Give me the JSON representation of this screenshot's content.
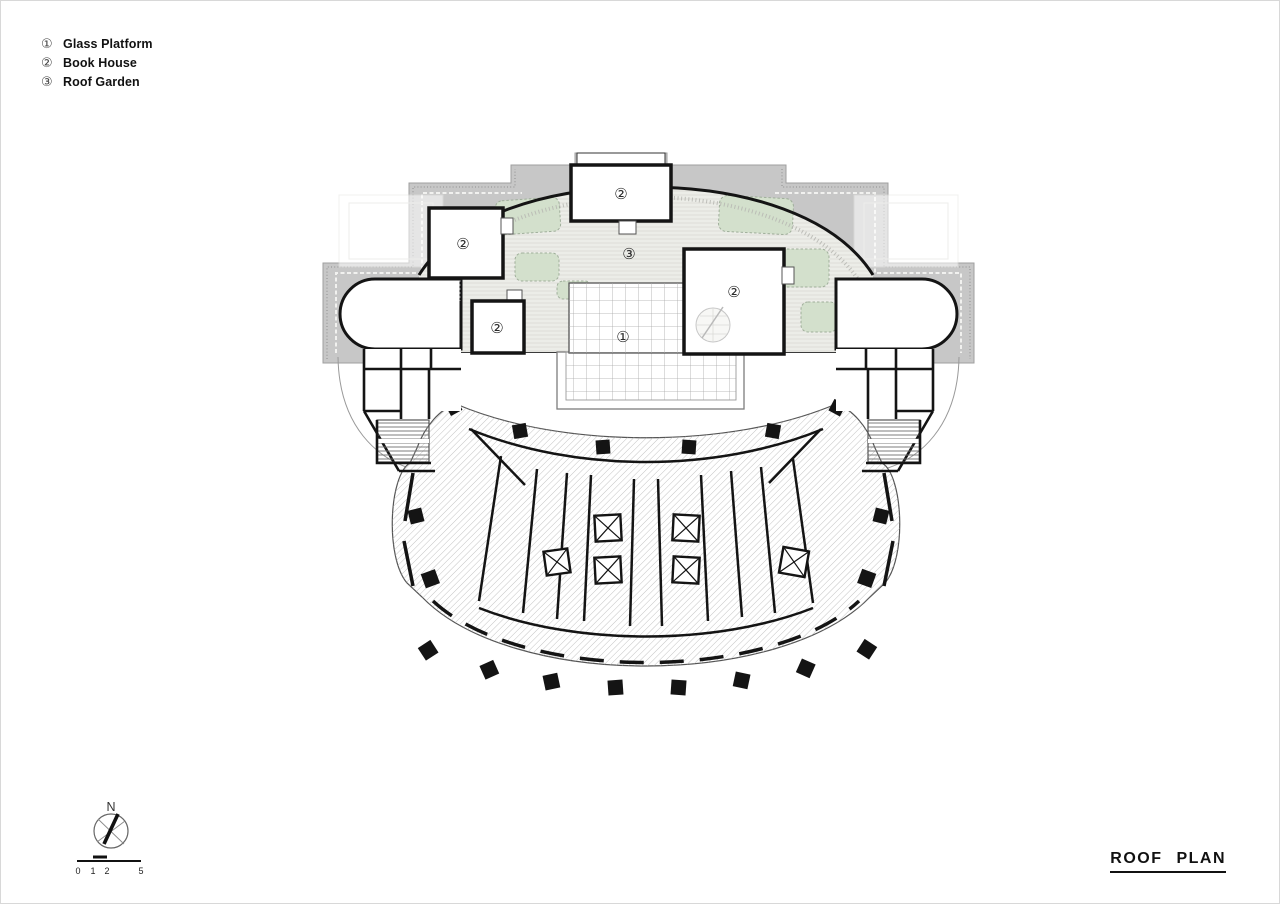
{
  "legend": {
    "items": [
      {
        "symbol": "①",
        "label": "Glass Platform"
      },
      {
        "symbol": "②",
        "label": "Book House"
      },
      {
        "symbol": "③",
        "label": "Roof Garden"
      }
    ]
  },
  "plan": {
    "markers": [
      {
        "symbol": "②",
        "area": "book-house-top"
      },
      {
        "symbol": "②",
        "area": "book-house-left"
      },
      {
        "symbol": "②",
        "area": "book-house-small"
      },
      {
        "symbol": "②",
        "area": "book-house-right"
      },
      {
        "symbol": "③",
        "area": "roof-garden"
      },
      {
        "symbol": "①",
        "area": "glass-platform"
      }
    ],
    "colors": {
      "parapet_gray": "#c7c7c7",
      "garden_fill": "#ecede8",
      "planting_green": "#d3e0cc",
      "wall_black": "#141414"
    }
  },
  "compass": {
    "label": "N"
  },
  "scale_bar": {
    "ticks": [
      "0",
      "1",
      "2",
      "5"
    ]
  },
  "title_block": {
    "text": "ROOF PLAN"
  }
}
